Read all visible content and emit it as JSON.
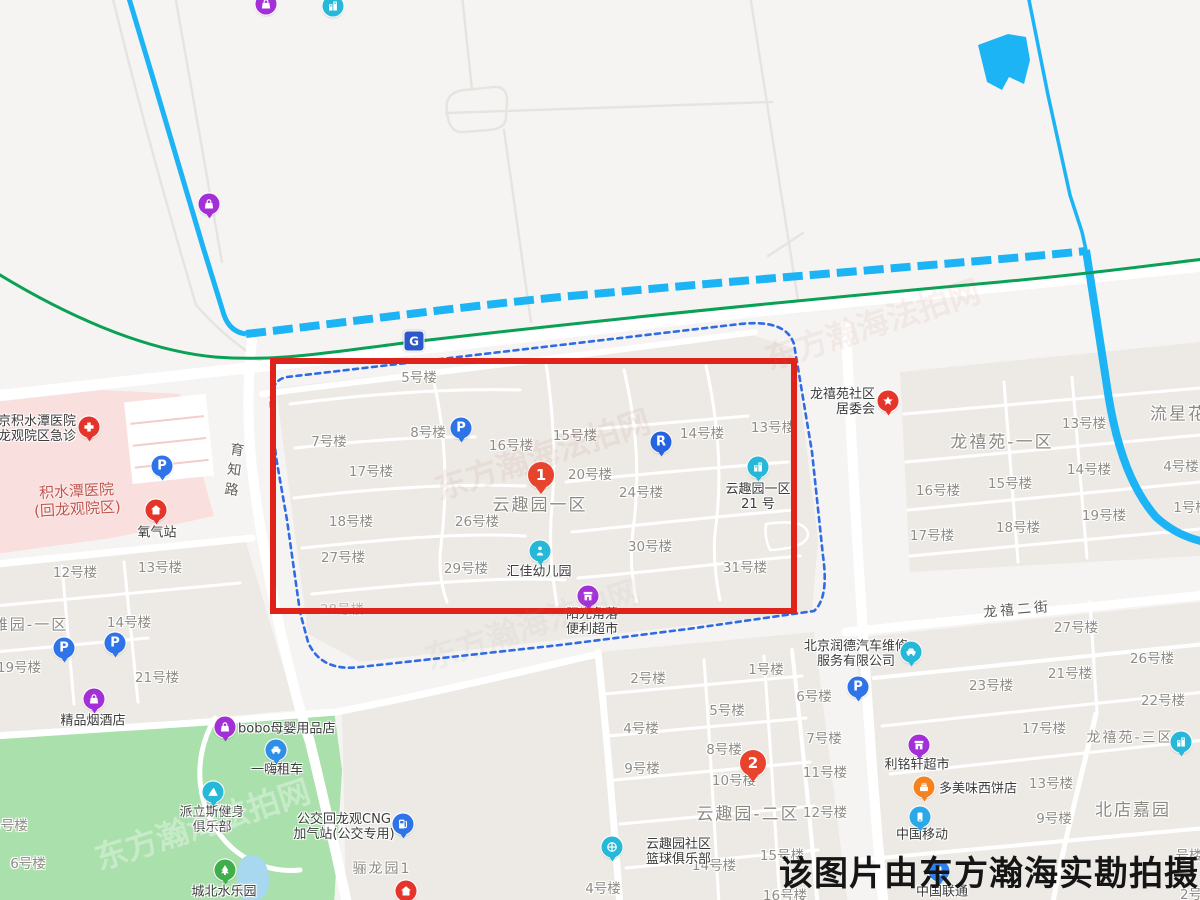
{
  "annotation": {
    "watermark_text": "该图片由东方瀚海实勘拍摄",
    "stamp_text": "东方瀚海法拍网",
    "red_box": {
      "x": 270,
      "y": 358,
      "w": 527,
      "h": 256,
      "color": "#e0231a"
    },
    "boundary_color": "#2f6be4"
  },
  "badge": {
    "glyph": "G",
    "x": 414,
    "y": 341
  },
  "road_labels": [
    {
      "text": "育知路",
      "x": 233,
      "y": 472,
      "vertical": true
    },
    {
      "text": "龙禧二街",
      "x": 1017,
      "y": 609,
      "rotate": -5
    }
  ],
  "area_labels": [
    {
      "text": "云趣园一区",
      "x": 540,
      "y": 503,
      "size": 17
    },
    {
      "text": "龙禧苑-一区",
      "x": 1002,
      "y": 440,
      "size": 17
    },
    {
      "text": "流星花园",
      "x": 1188,
      "y": 412,
      "size": 17
    },
    {
      "text": "云趣园-二区",
      "x": 748,
      "y": 812,
      "size": 17
    },
    {
      "text": "北店嘉园",
      "x": 1133,
      "y": 808,
      "size": 17
    },
    {
      "text": "风雅园-一区",
      "x": 22,
      "y": 624,
      "size": 15
    },
    {
      "text": "骊龙园1",
      "x": 382,
      "y": 868,
      "size": 14
    },
    {
      "text": "龙禧苑-三区",
      "x": 1130,
      "y": 737,
      "size": 14
    }
  ],
  "red_area_text": {
    "lines": [
      "积水潭医院",
      "(回龙观院区)"
    ],
    "x": 77,
    "y": 500
  },
  "building_labels": [
    {
      "t": "5号楼",
      "x": 419,
      "y": 376
    },
    {
      "t": "7号楼",
      "x": 329,
      "y": 440
    },
    {
      "t": "8号楼",
      "x": 428,
      "y": 431
    },
    {
      "t": "16号楼",
      "x": 511,
      "y": 444
    },
    {
      "t": "15号楼",
      "x": 575,
      "y": 434
    },
    {
      "t": "14号楼",
      "x": 702,
      "y": 432
    },
    {
      "t": "13号楼",
      "x": 773,
      "y": 426
    },
    {
      "t": "17号楼",
      "x": 371,
      "y": 470
    },
    {
      "t": "20号楼",
      "x": 590,
      "y": 473
    },
    {
      "t": "24号楼",
      "x": 641,
      "y": 491
    },
    {
      "t": "18号楼",
      "x": 351,
      "y": 520
    },
    {
      "t": "26号楼",
      "x": 477,
      "y": 520
    },
    {
      "t": "27号楼",
      "x": 343,
      "y": 556
    },
    {
      "t": "29号楼",
      "x": 466,
      "y": 567
    },
    {
      "t": "30号楼",
      "x": 650,
      "y": 545
    },
    {
      "t": "31号楼",
      "x": 745,
      "y": 566
    },
    {
      "t": "28号楼",
      "x": 342,
      "y": 608,
      "dim": true
    },
    {
      "t": "1号楼",
      "x": 766,
      "y": 668
    },
    {
      "t": "2号楼",
      "x": 648,
      "y": 677
    },
    {
      "t": "6号楼",
      "x": 814,
      "y": 695
    },
    {
      "t": "5号楼",
      "x": 727,
      "y": 709
    },
    {
      "t": "4号楼",
      "x": 641,
      "y": 727
    },
    {
      "t": "7号楼",
      "x": 824,
      "y": 737
    },
    {
      "t": "8号楼",
      "x": 724,
      "y": 748
    },
    {
      "t": "9号楼",
      "x": 642,
      "y": 767
    },
    {
      "t": "10号楼",
      "x": 734,
      "y": 779
    },
    {
      "t": "11号楼",
      "x": 825,
      "y": 771
    },
    {
      "t": "12号楼",
      "x": 825,
      "y": 811
    },
    {
      "t": "15号楼",
      "x": 782,
      "y": 854
    },
    {
      "t": "14号楼",
      "x": 714,
      "y": 864
    },
    {
      "t": "16号楼",
      "x": 785,
      "y": 894
    },
    {
      "t": "4号楼",
      "x": 603,
      "y": 887
    },
    {
      "t": "13号楼",
      "x": 1084,
      "y": 422
    },
    {
      "t": "14号楼",
      "x": 1089,
      "y": 468
    },
    {
      "t": "4号楼",
      "x": 1181,
      "y": 465
    },
    {
      "t": "16号楼",
      "x": 938,
      "y": 489
    },
    {
      "t": "15号楼",
      "x": 1010,
      "y": 482
    },
    {
      "t": "1号楼",
      "x": 1191,
      "y": 506
    },
    {
      "t": "19号楼",
      "x": 1104,
      "y": 514
    },
    {
      "t": "18号楼",
      "x": 1018,
      "y": 526
    },
    {
      "t": "17号楼",
      "x": 932,
      "y": 534
    },
    {
      "t": "27号楼",
      "x": 1076,
      "y": 626
    },
    {
      "t": "26号楼",
      "x": 1152,
      "y": 657
    },
    {
      "t": "21号楼",
      "x": 1070,
      "y": 672
    },
    {
      "t": "23号楼",
      "x": 991,
      "y": 684
    },
    {
      "t": "22号楼",
      "x": 1163,
      "y": 699
    },
    {
      "t": "17号楼",
      "x": 1044,
      "y": 727
    },
    {
      "t": "13号楼",
      "x": 1051,
      "y": 782
    },
    {
      "t": "9号楼",
      "x": 1054,
      "y": 817
    },
    {
      "t": "号楼",
      "x": 1189,
      "y": 854
    },
    {
      "t": "2号",
      "x": 1191,
      "y": 893
    },
    {
      "t": "12号楼",
      "x": 75,
      "y": 571
    },
    {
      "t": "13号楼",
      "x": 160,
      "y": 566
    },
    {
      "t": "14号楼",
      "x": 129,
      "y": 621
    },
    {
      "t": "19号楼",
      "x": 19,
      "y": 666
    },
    {
      "t": "21号楼",
      "x": 157,
      "y": 676
    },
    {
      "t": "5号楼",
      "x": 10,
      "y": 824
    },
    {
      "t": "6号楼",
      "x": 28,
      "y": 862
    }
  ],
  "markers": [
    {
      "name": "hospital-emergency-marker",
      "glyph": "cross",
      "color": "#e5352b",
      "x": 89,
      "y": 427,
      "label": {
        "lines": [
          "北京积水潭医院",
          "回龙观院区急诊"
        ],
        "x": 76,
        "y": 429,
        "pos": "right"
      }
    },
    {
      "name": "hospital-parking-marker",
      "glyph": "P",
      "color": "#2e73e8",
      "x": 162,
      "y": 466
    },
    {
      "name": "oxygen-station-marker",
      "glyph": "house",
      "color": "#e5352b",
      "x": 156,
      "y": 510,
      "label": {
        "lines": [
          "氧气站"
        ],
        "x": 157,
        "y": 533
      }
    },
    {
      "name": "shop-marker-northwest",
      "glyph": "bag",
      "color": "#a32fd6",
      "x": 209,
      "y": 204
    },
    {
      "name": "shop-marker-top-edge",
      "glyph": "bag",
      "color": "#a32fd6",
      "x": 266,
      "y": 4,
      "shape": "dot"
    },
    {
      "name": "poi-marker-top-edge",
      "glyph": "building",
      "color": "#26b8d8",
      "x": 333,
      "y": 6,
      "shape": "dot"
    },
    {
      "name": "parking-marker-yunquyuan",
      "glyph": "P",
      "color": "#2e73e8",
      "x": 461,
      "y": 428
    },
    {
      "name": "rideshare-marker",
      "glyph": "R",
      "color": "#2663e0",
      "x": 661,
      "y": 442
    },
    {
      "name": "route-pin-1",
      "glyph": "1",
      "color": "#e8432d",
      "x": 541,
      "y": 475,
      "big": true
    },
    {
      "name": "yunquyuan-21-marker",
      "glyph": "building",
      "color": "#26b8d8",
      "x": 758,
      "y": 467,
      "label": {
        "lines": [
          "云趣园一区",
          "21 号"
        ],
        "x": 758,
        "y": 497
      }
    },
    {
      "name": "kindergarten-marker",
      "glyph": "person",
      "color": "#26b8d8",
      "x": 540,
      "y": 551,
      "label": {
        "lines": [
          "汇佳幼儿园"
        ],
        "x": 539,
        "y": 572
      }
    },
    {
      "name": "convenience-store-marker",
      "glyph": "store",
      "color": "#a32fd6",
      "x": 588,
      "y": 596,
      "label": {
        "lines": [
          "阳光角落",
          "便利超市"
        ],
        "x": 592,
        "y": 622
      }
    },
    {
      "name": "committee-star-marker",
      "glyph": "star",
      "color": "#e5352b",
      "x": 888,
      "y": 401,
      "label": {
        "lines": [
          "龙禧苑社区",
          "居委会"
        ],
        "x": 875,
        "y": 402,
        "pos": "right"
      }
    },
    {
      "name": "longxiyuan3-marker",
      "glyph": "building",
      "color": "#26b8d8",
      "x": 1181,
      "y": 742
    },
    {
      "name": "auto-repair-marker",
      "glyph": "car",
      "color": "#26b8d8",
      "x": 911,
      "y": 652,
      "label": {
        "lines": [
          "北京润德汽车维修",
          "服务有限公司"
        ],
        "x": 856,
        "y": 654
      }
    },
    {
      "name": "parking-marker-east",
      "glyph": "P",
      "color": "#2e73e8",
      "x": 858,
      "y": 687
    },
    {
      "name": "liminxuan-market-marker",
      "glyph": "store",
      "color": "#a32fd6",
      "x": 919,
      "y": 745,
      "label": {
        "lines": [
          "利铭轩超市"
        ],
        "x": 917,
        "y": 765
      }
    },
    {
      "name": "bakery-marker",
      "glyph": "cake",
      "color": "#f5821f",
      "x": 924,
      "y": 787,
      "label": {
        "lines": [
          "多美味西饼店"
        ],
        "x": 939,
        "y": 789,
        "pos": "left"
      }
    },
    {
      "name": "china-mobile-marker",
      "glyph": "phone",
      "color": "#2aa8e8",
      "x": 920,
      "y": 817,
      "label": {
        "lines": [
          "中国移动"
        ],
        "x": 922,
        "y": 835
      }
    },
    {
      "name": "china-unicom-marker",
      "glyph": "phone",
      "color": "#2f80e8",
      "x": 939,
      "y": 871,
      "label": {
        "lines": [
          "中国联通"
        ],
        "x": 942,
        "y": 892
      }
    },
    {
      "name": "basketball-club-marker",
      "glyph": "basketball",
      "color": "#26b8d8",
      "x": 612,
      "y": 847,
      "label": {
        "lines": [
          "云趣园社区",
          "篮球俱乐部"
        ],
        "x": 646,
        "y": 852,
        "pos": "left"
      }
    },
    {
      "name": "route-pin-2",
      "glyph": "2",
      "color": "#e8432d",
      "x": 753,
      "y": 763,
      "big": true
    },
    {
      "name": "parking-marker-west-1",
      "glyph": "P",
      "color": "#2e73e8",
      "x": 64,
      "y": 648
    },
    {
      "name": "parking-marker-west-2",
      "glyph": "P",
      "color": "#2e73e8",
      "x": 115,
      "y": 643
    },
    {
      "name": "tobacco-shop-marker",
      "glyph": "bag",
      "color": "#a32fd6",
      "x": 94,
      "y": 699,
      "label": {
        "lines": [
          "精品烟酒店"
        ],
        "x": 93,
        "y": 721
      }
    },
    {
      "name": "bobo-shop-marker",
      "glyph": "bag",
      "color": "#a32fd6",
      "x": 225,
      "y": 727,
      "label": {
        "lines": [
          "bobo母婴用品店"
        ],
        "x": 238,
        "y": 729,
        "pos": "left"
      }
    },
    {
      "name": "car-rental-marker",
      "glyph": "car",
      "color": "#2f8fe8",
      "x": 276,
      "y": 750,
      "label": {
        "lines": [
          "一嗨租车"
        ],
        "x": 277,
        "y": 770
      }
    },
    {
      "name": "gym-marker",
      "glyph": "mountain",
      "color": "#26b8d8",
      "x": 213,
      "y": 792,
      "label": {
        "lines": [
          "派立斯健身",
          "俱乐部"
        ],
        "x": 212,
        "y": 820
      }
    },
    {
      "name": "cng-station-marker",
      "glyph": "fuel",
      "color": "#2e73e8",
      "x": 403,
      "y": 824,
      "label": {
        "lines": [
          "公交回龙观CNG",
          "加气站(公交专用)"
        ],
        "x": 344,
        "y": 827
      }
    },
    {
      "name": "water-park-marker",
      "glyph": "tree",
      "color": "#3eaf4a",
      "x": 225,
      "y": 870,
      "label": {
        "lines": [
          "城北水乐园"
        ],
        "x": 224,
        "y": 892
      }
    },
    {
      "name": "home-marker-south",
      "glyph": "house",
      "color": "#e5352b",
      "x": 406,
      "y": 891
    }
  ]
}
